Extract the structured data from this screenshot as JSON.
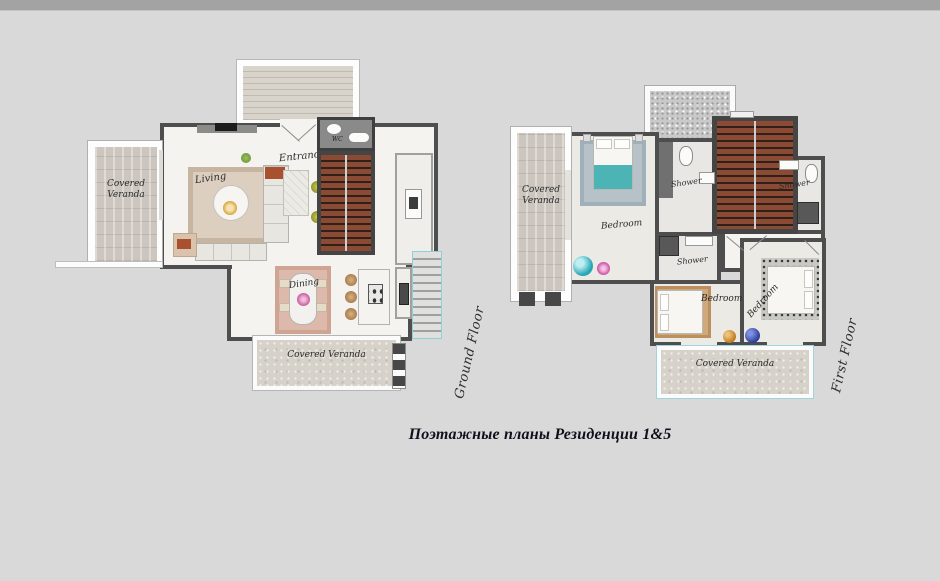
{
  "caption": "Поэтажные планы Резиденции 1&5",
  "ground_floor": {
    "floor_label": "Ground Floor",
    "covered_veranda_left": "Covered Veranda",
    "living": "Living",
    "entrance": "Entrance",
    "wc": "WC",
    "dining": "Dining",
    "covered_veranda_bottom": "Covered Veranda"
  },
  "first_floor": {
    "floor_label": "First Floor",
    "covered_veranda_left": "Covered Veranda",
    "bedroom_master": "Bedroom",
    "shower_top": "Shower",
    "shower_right": "Shower",
    "shower_middle": "Shower",
    "bedroom_left": "Bedroom",
    "bedroom_right": "Bedroom",
    "covered_veranda_bottom": "Covered Veranda"
  },
  "colors": {
    "background": "#d9d9d9",
    "top_strip": "#a3a3a3",
    "walls": "#4e4e4e",
    "floor": "#f5f3ef",
    "stair_wood": "#8a4a33",
    "teal_accent": "#27a6b5",
    "teal_bed": "#4db4b6",
    "pink_flower": "#cc3f9f",
    "blue_pouf": "#2b3c9c",
    "gold_pouf": "#bd7a1e",
    "caption_text": "#10101d"
  }
}
